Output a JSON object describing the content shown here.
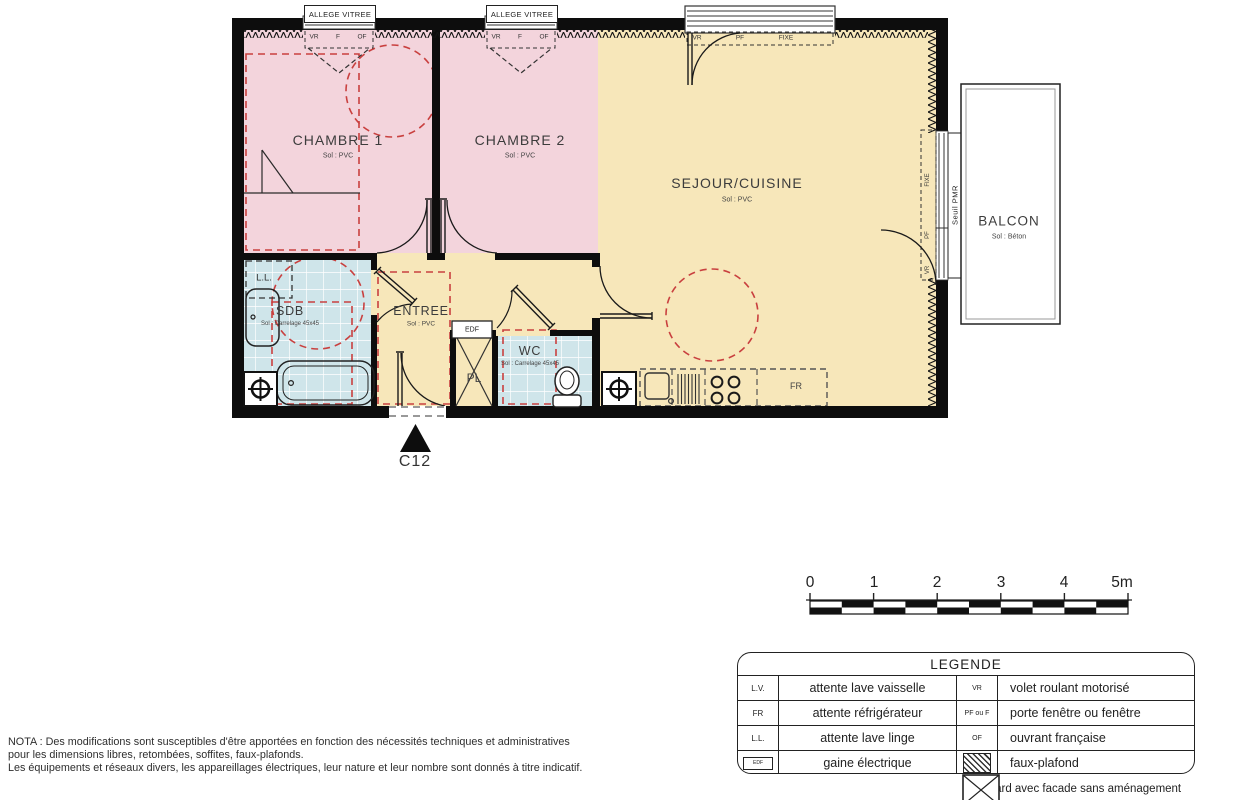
{
  "unit": {
    "label": "C12"
  },
  "rooms": {
    "chambre1": {
      "name": "CHAMBRE 1",
      "floor": "Sol : PVC"
    },
    "chambre2": {
      "name": "CHAMBRE 2",
      "floor": "Sol : PVC"
    },
    "sejour": {
      "name": "SEJOUR/CUISINE",
      "floor": "Sol : PVC"
    },
    "balcon": {
      "name": "BALCON",
      "floor": "Sol : Béton"
    },
    "sdb": {
      "name": "SDB",
      "floor": "Sol : Carrelage 45x45"
    },
    "entree": {
      "name": "ENTREE",
      "floor": "Sol : PVC"
    },
    "wc": {
      "name": "WC",
      "floor": "Sol : Carrelage 45x45"
    },
    "pl": {
      "name": "PL"
    }
  },
  "marks": {
    "allege_vitree": "ALLEGE VITREE",
    "vr": "VR",
    "f": "F",
    "of": "OF",
    "pf": "PF",
    "fixe": "FIXE",
    "seuil_pmr": "Seuil PMR",
    "edf": "EDF",
    "ll": "L.L.",
    "fr": "FR"
  },
  "scalebar": {
    "labels": [
      "0",
      "1",
      "2",
      "3",
      "4",
      "5m"
    ]
  },
  "legend": {
    "title": "LEGENDE",
    "rows": [
      {
        "sym1": "L.V.",
        "desc1": "attente lave vaisselle",
        "sym2": "VR",
        "desc2": "volet roulant motorisé"
      },
      {
        "sym1": "FR",
        "desc1": "attente réfrigérateur",
        "sym2": "PF ou F",
        "desc2": "porte fenêtre ou fenêtre"
      },
      {
        "sym1": "L.L.",
        "desc1": "attente lave linge",
        "sym2": "OF",
        "desc2": "ouvrant française"
      },
      {
        "sym1": "EDF",
        "desc1": "gaine électrique",
        "sym2": "",
        "desc2": "faux-plafond"
      }
    ],
    "placard_label": "placard avec facade sans aménagement"
  },
  "nota": {
    "line1": "NOTA : Des modifications sont susceptibles d'être apportées en fonction des nécessités techniques et administratives",
    "line2": "pour les dimensions libres, retombées, soffites, faux-plafonds.",
    "line3": "Les équipements et réseaux divers, les appareillages électriques, leur nature et leur nombre sont donnés à titre indicatif."
  },
  "colors": {
    "room_pink": "#f3d4dc",
    "room_yellow": "#f7e7ba",
    "room_blue": "#cfe5ea",
    "red_dash": "#c9403f",
    "wall": "#0d0d0d"
  }
}
